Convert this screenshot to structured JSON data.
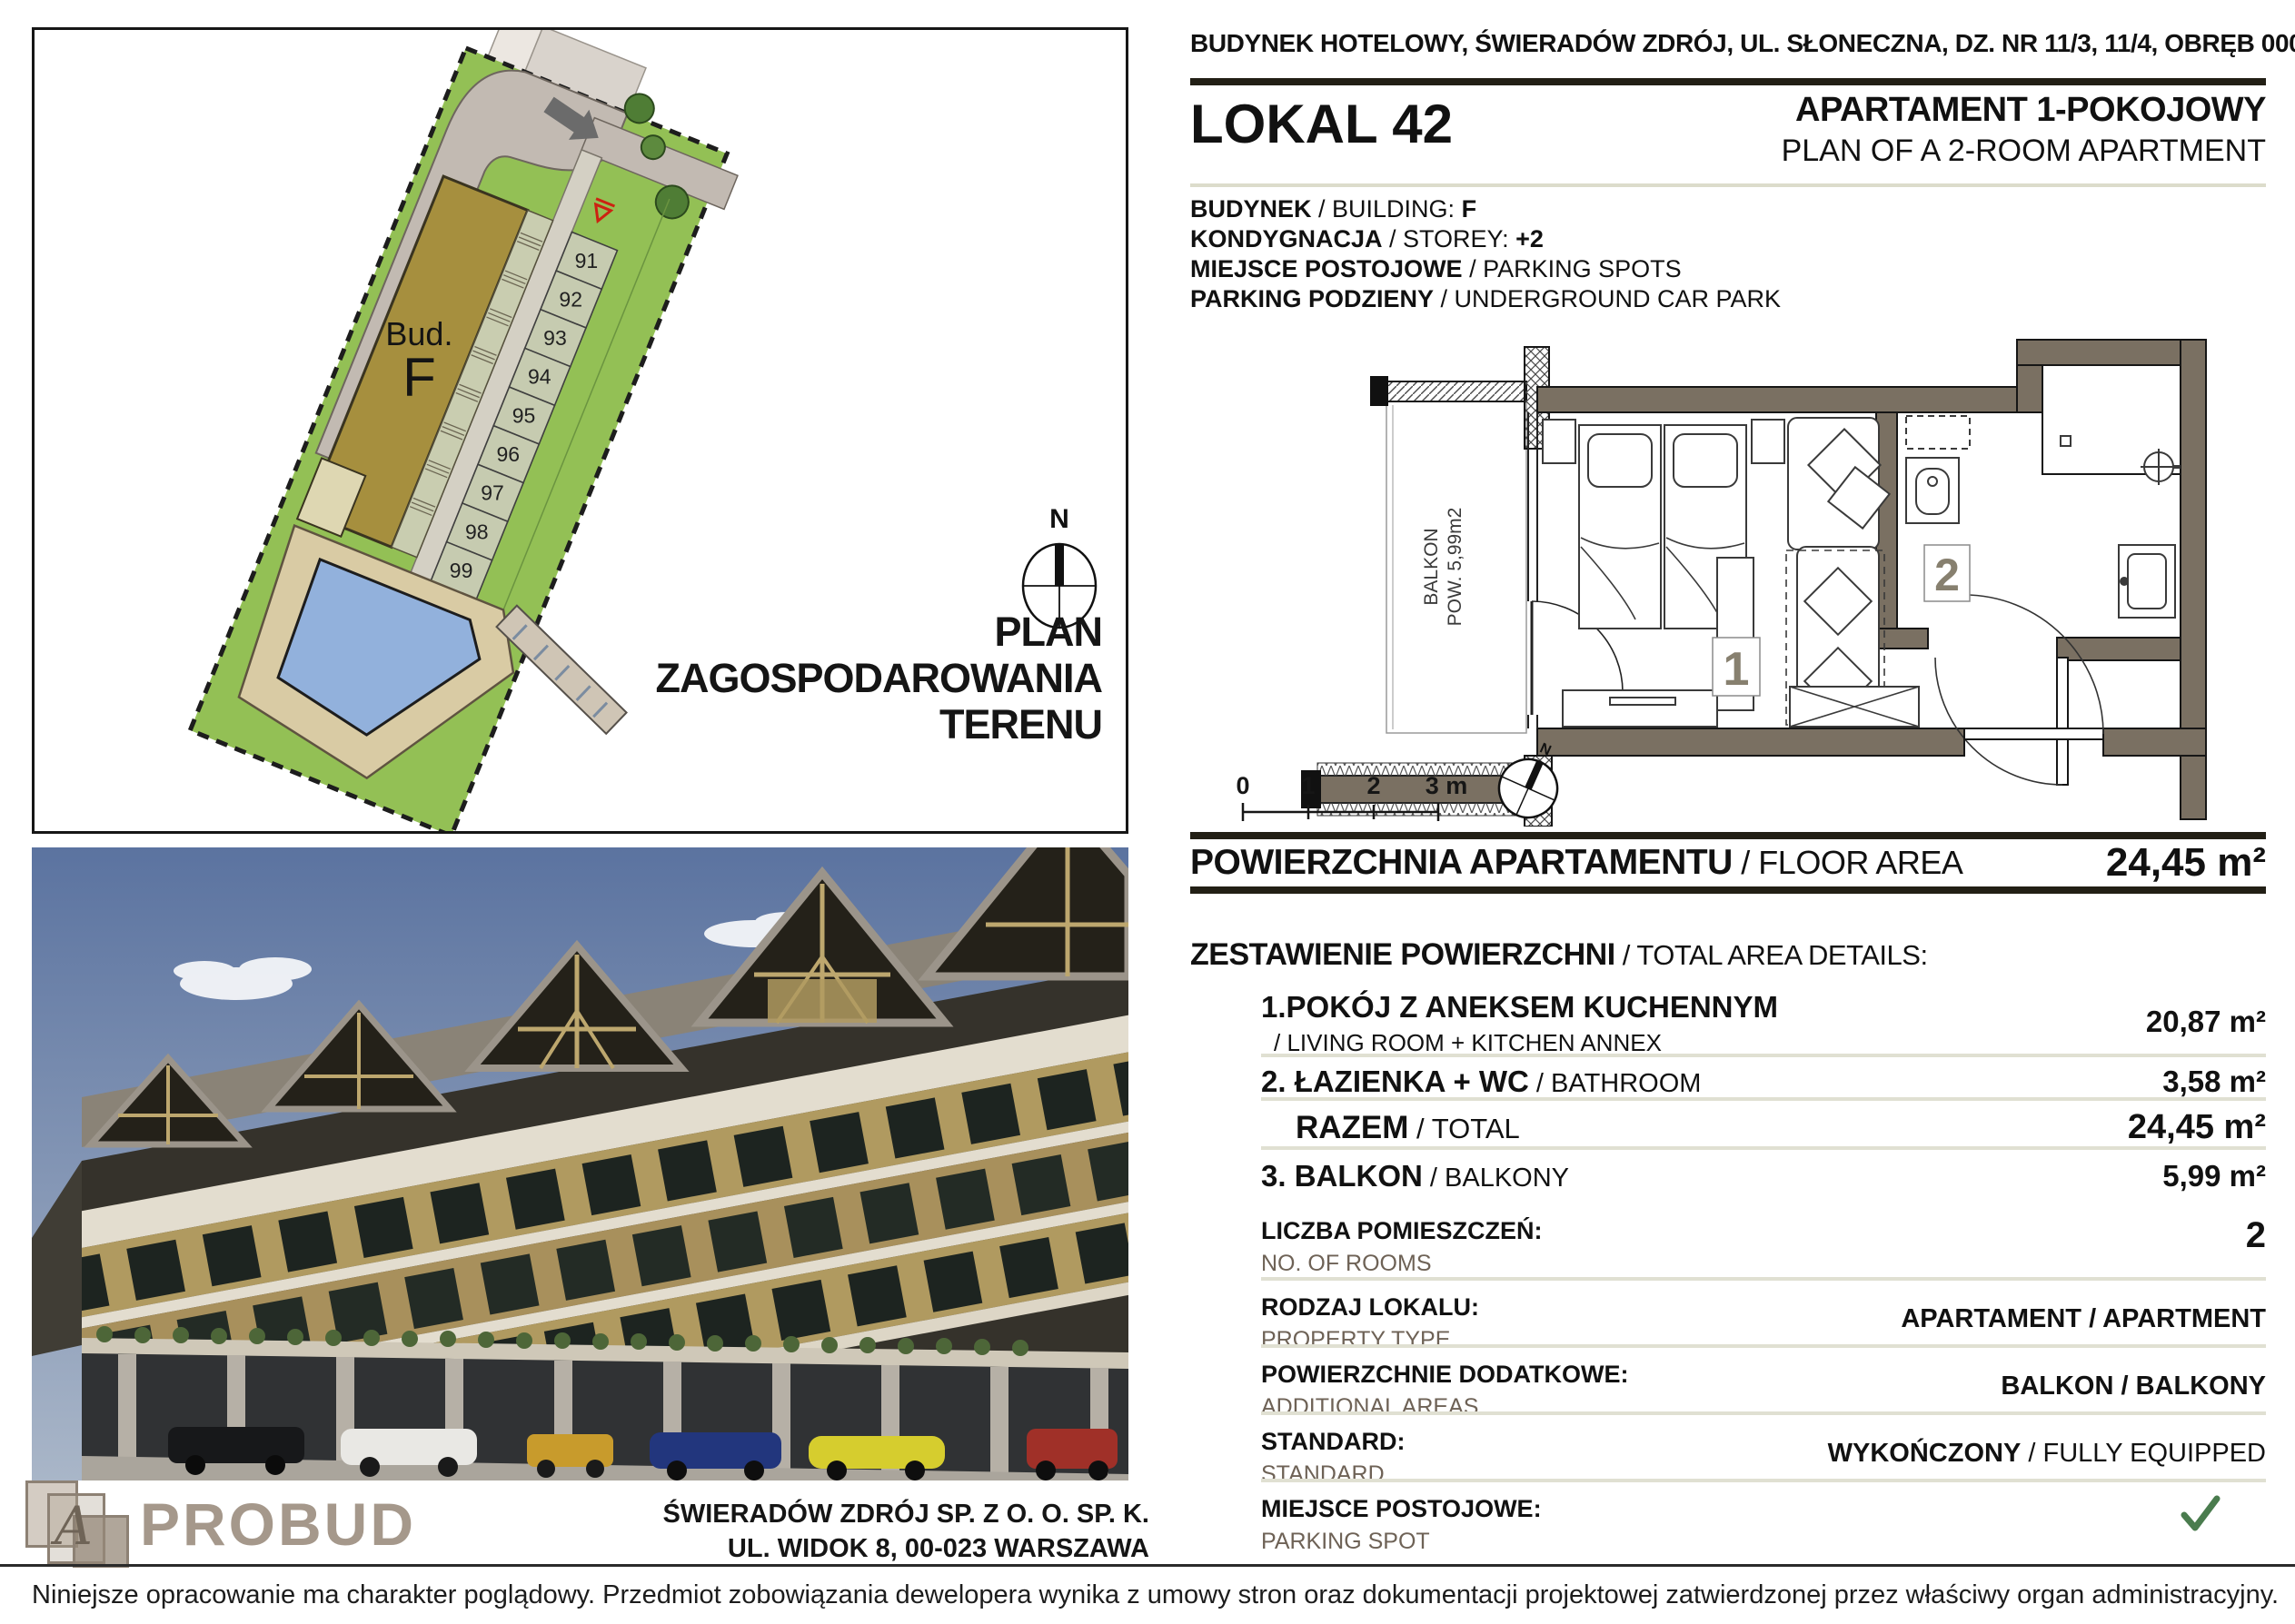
{
  "header": {
    "project_title": "BUDYNEK HOTELOWY, ŚWIERADÓW ZDRÓJ, UL. SŁONECZNA, DZ. NR 11/3, 11/4, OBRĘB 0004",
    "lokal": "LOKAL 42",
    "type_pl": "APARTAMENT 1-POKOJOWY",
    "type_en": "PLAN OF A 2-ROOM APARTMENT"
  },
  "info_lines": [
    {
      "pl": "BUDYNEK",
      "en": " / BUILDING: ",
      "value": "F"
    },
    {
      "pl": "KONDYGNACJA",
      "en": " / STOREY: ",
      "value": "+2"
    },
    {
      "pl": "MIEJSCE POSTOJOWE",
      "en": " / PARKING SPOTS",
      "value": ""
    },
    {
      "pl": "PARKING PODZIENY",
      "en": " / UNDERGROUND CAR PARK",
      "value": ""
    }
  ],
  "floor_area_bar": {
    "label_pl": "POWIERZCHNIA APARTAMENTU",
    "label_en": " / FLOOR AREA",
    "value": "24,45 m²"
  },
  "area": {
    "heading_pl": "ZESTAWIENIE POWIERZCHNI",
    "heading_en": " / TOTAL AREA DETAILS:",
    "rows": [
      {
        "pl": "1.POKÓJ Z ANEKSEM KUCHENNYM",
        "sub": "/ LIVING ROOM + KITCHEN ANNEX",
        "value": "20,87 m²"
      },
      {
        "pl": "2. ŁAZIENKA + WC",
        "en": " / BATHROOM",
        "value": "3,58 m²"
      },
      {
        "pl": "RAZEM",
        "en": " / TOTAL",
        "value": "24,45 m²"
      },
      {
        "pl": "3. BALKON",
        "en": " / BALKONY",
        "value": "5,99 m²"
      }
    ],
    "props": [
      {
        "pl": "LICZBA POMIESZCZEŃ:",
        "en": "NO. OF ROOMS",
        "value": "2"
      },
      {
        "pl": "RODZAJ LOKALU:",
        "en": "PROPERTY TYPE",
        "value": "APARTAMENT / APARTMENT"
      },
      {
        "pl": "POWIERZCHNIE DODATKOWE:",
        "en": "ADDITIONAL AREAS",
        "value": "BALKON / BALKONY"
      },
      {
        "pl": "STANDARD:",
        "en": "STANDARD",
        "value": "WYKOŃCZONY / FULLY EQUIPPED"
      },
      {
        "pl": "MIEJSCE POSTOJOWE:",
        "en": "PARKING SPOT",
        "value": "✓"
      }
    ]
  },
  "site_plan": {
    "building_label": "Bud.",
    "building_letter": "F",
    "parking_numbers": [
      "91",
      "92",
      "93",
      "94",
      "95",
      "96",
      "97",
      "98",
      "99"
    ],
    "caption_lines": [
      "PLAN",
      "ZAGOSPODAROWANIA",
      "TERENU"
    ],
    "north_label": "N"
  },
  "floor_plan": {
    "balcony_line1": "BALKON",
    "balcony_line2": "POW. 5,99m2",
    "room1": "1",
    "room2": "2",
    "scale_ticks": [
      "0",
      "1",
      "2",
      "3 m"
    ],
    "north_label": "N"
  },
  "footer": {
    "brand": "PROBUD",
    "address_line1": "ŚWIERADÓW ZDRÓJ SP. Z O. O. SP. K.",
    "address_line2": "UL. WIDOK 8, 00-023 WARSZAWA",
    "disclaimer": "Niniejsze opracowanie ma charakter poglądowy. Przedmiot zobowiązania dewelopera wynika z umowy stron oraz dokumentacji projektowej zatwierdzonej przez właściwy organ administracyjny."
  },
  "colors": {
    "wall_taupe": "#7a7062",
    "check_green": "#4a7c4e",
    "rule_dark": "#221f15",
    "rule_light": "#e0e0d2",
    "logo_taupe": "#a5988b",
    "site_green": "#93c055",
    "building_olive": "#a68f3e",
    "pool_blue": "#92b1dc"
  }
}
